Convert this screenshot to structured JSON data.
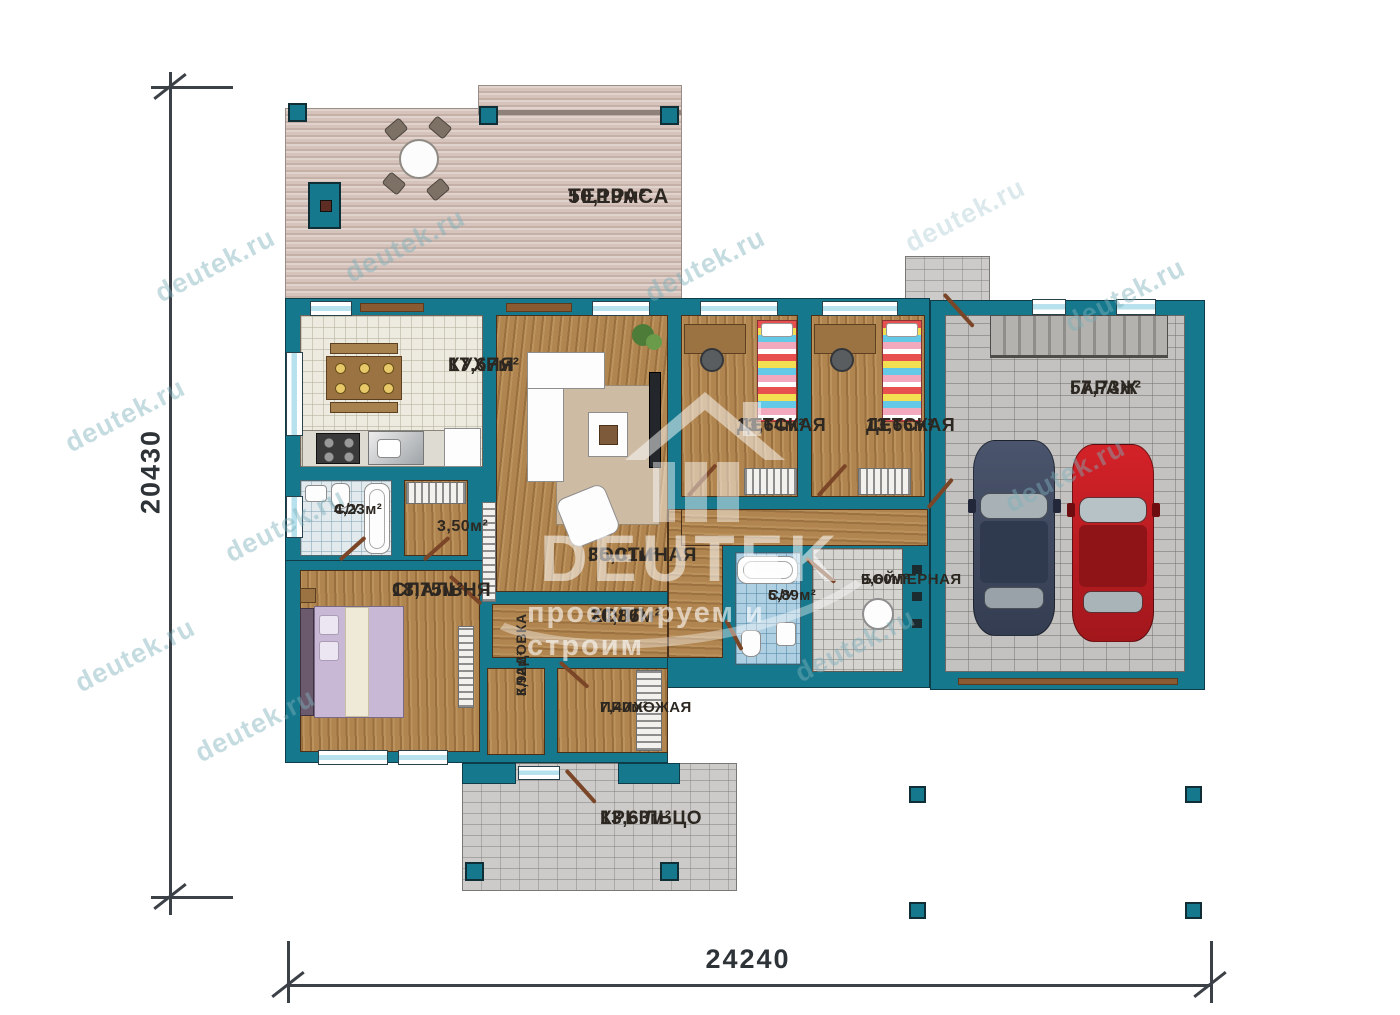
{
  "watermark": {
    "site": "deutek.ru",
    "brand": "DEUTEK",
    "tagline": "проектируем и строим"
  },
  "dimensions": {
    "height": "20430",
    "width": "24240"
  },
  "rooms": {
    "terrace": {
      "name": "ТЕРРАСА",
      "area": "50,19м²"
    },
    "kitchen": {
      "name": "КУХНЯ",
      "area": "17,67м²"
    },
    "living": {
      "name": "ГОСТИНАЯ",
      "area": "35,01м²"
    },
    "child1": {
      "name": "ДЕТСКАЯ",
      "area": "13,64м²"
    },
    "child2": {
      "name": "ДЕТСКАЯ",
      "area": "13,66м²"
    },
    "garage": {
      "name": "ГАРАЖ",
      "area": "57,73м²"
    },
    "bath1": {
      "name": "С/У",
      "area": "4,23м²"
    },
    "closet": {
      "area": "3,50м²"
    },
    "bedroom": {
      "name": "СПАЛЬНЯ",
      "area": "18,75м²"
    },
    "hall": {
      "name": "ХОЛЛ",
      "area": "20,86м²"
    },
    "storage": {
      "name": "КЛАДОВКА",
      "area": "3,92м²"
    },
    "entry": {
      "name": "ПРИХОЖАЯ",
      "area": "7,40м²"
    },
    "bath2": {
      "name": "С/У",
      "area": "5,89м²"
    },
    "boiler": {
      "name": "БОЙЛЕРНАЯ",
      "area": "9,60м²"
    },
    "porch": {
      "name": "КРЫЛЬЦО",
      "area": "13,63м²"
    }
  },
  "colors": {
    "wall": "#16788c",
    "car_red": "#c41e24",
    "car_dark": "#3d4659"
  }
}
